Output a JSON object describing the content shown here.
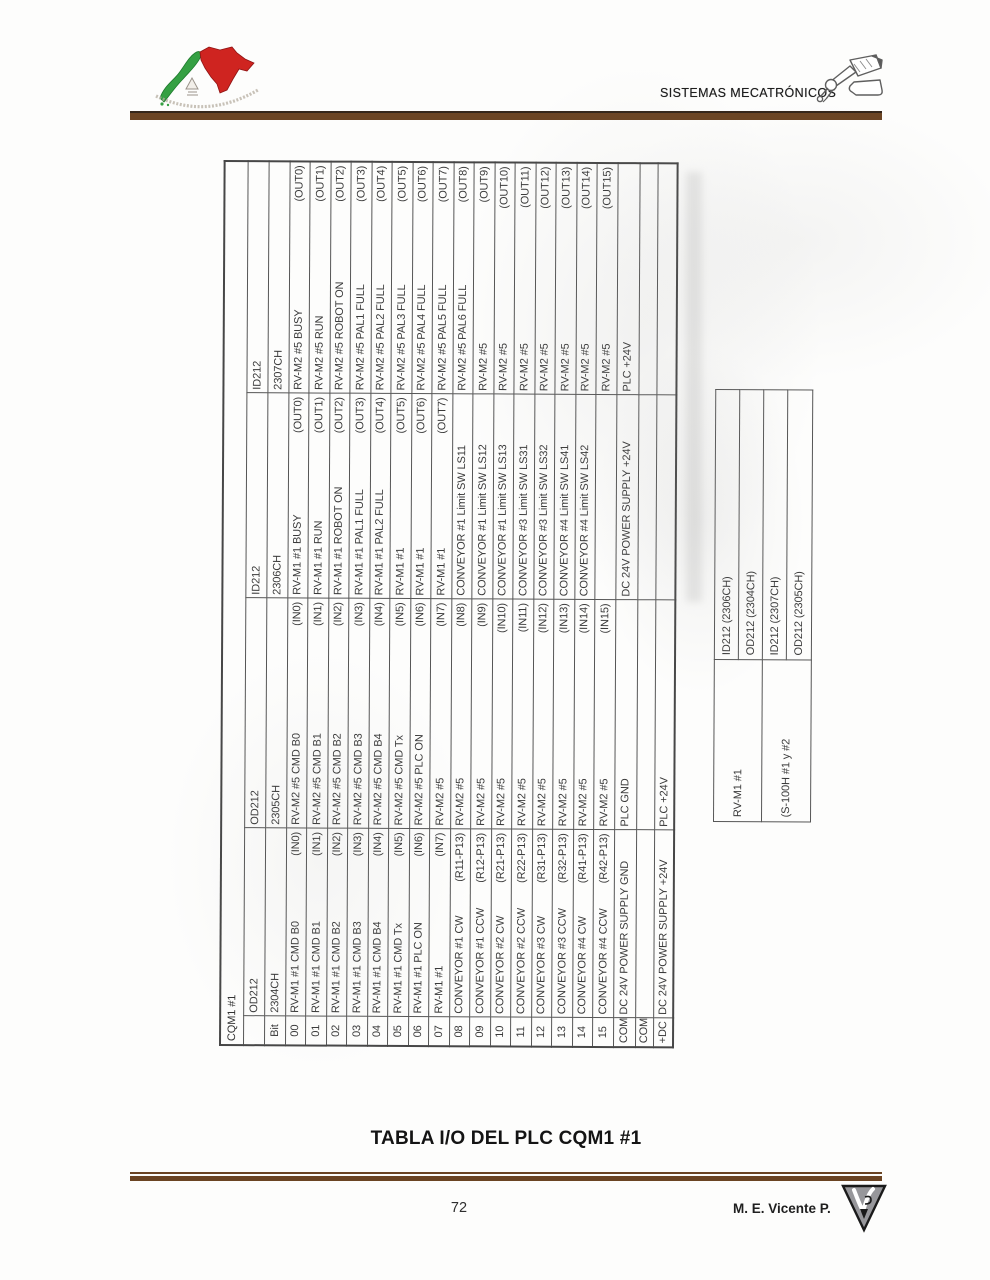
{
  "header": {
    "title": "SISTEMAS MECATRÓNICOS"
  },
  "main_table": {
    "title": "CQM1 #1",
    "bit_label": "Bit",
    "columns": [
      {
        "card": "OD212",
        "channel": "2304CH"
      },
      {
        "card": "OD212",
        "channel": "2305CH"
      },
      {
        "card": "ID212",
        "channel": "2306CH"
      },
      {
        "card": "ID212",
        "channel": "2307CH"
      }
    ],
    "rows": [
      {
        "bit": "00",
        "cells": [
          {
            "label": "RV-M1 #1 CMD B0",
            "pin": "(IN0)"
          },
          {
            "label": "RV-M2 #5 CMD B0",
            "pin": "(IN0)"
          },
          {
            "label": "RV-M1 #1 BUSY",
            "pin": "(OUT0)"
          },
          {
            "label": "RV-M2 #5 BUSY",
            "pin": "(OUT0)"
          }
        ]
      },
      {
        "bit": "01",
        "cells": [
          {
            "label": "RV-M1 #1 CMD B1",
            "pin": "(IN1)"
          },
          {
            "label": "RV-M2 #5 CMD B1",
            "pin": "(IN1)"
          },
          {
            "label": "RV-M1 #1 RUN",
            "pin": "(OUT1)"
          },
          {
            "label": "RV-M2 #5 RUN",
            "pin": "(OUT1)"
          }
        ]
      },
      {
        "bit": "02",
        "cells": [
          {
            "label": "RV-M1 #1 CMD B2",
            "pin": "(IN2)"
          },
          {
            "label": "RV-M2 #5 CMD B2",
            "pin": "(IN2)"
          },
          {
            "label": "RV-M1 #1 ROBOT ON",
            "pin": "(OUT2)"
          },
          {
            "label": "RV-M2 #5 ROBOT ON",
            "pin": "(OUT2)"
          }
        ]
      },
      {
        "bit": "03",
        "cells": [
          {
            "label": "RV-M1 #1 CMD B3",
            "pin": "(IN3)"
          },
          {
            "label": "RV-M2 #5 CMD B3",
            "pin": "(IN3)"
          },
          {
            "label": "RV-M1 #1 PAL1 FULL",
            "pin": "(OUT3)"
          },
          {
            "label": "RV-M2 #5 PAL1 FULL",
            "pin": "(OUT3)"
          }
        ]
      },
      {
        "bit": "04",
        "cells": [
          {
            "label": "RV-M1 #1 CMD B4",
            "pin": "(IN4)"
          },
          {
            "label": "RV-M2 #5 CMD B4",
            "pin": "(IN4)"
          },
          {
            "label": "RV-M1 #1 PAL2 FULL",
            "pin": "(OUT4)"
          },
          {
            "label": "RV-M2 #5 PAL2 FULL",
            "pin": "(OUT4)"
          }
        ]
      },
      {
        "bit": "05",
        "cells": [
          {
            "label": "RV-M1 #1 CMD Tx",
            "pin": "(IN5)"
          },
          {
            "label": "RV-M2 #5 CMD Tx",
            "pin": "(IN5)"
          },
          {
            "label": "RV-M1 #1",
            "pin": "(OUT5)"
          },
          {
            "label": "RV-M2 #5 PAL3 FULL",
            "pin": "(OUT5)"
          }
        ]
      },
      {
        "bit": "06",
        "cells": [
          {
            "label": "RV-M1 #1 PLC ON",
            "pin": "(IN6)"
          },
          {
            "label": "RV-M2 #5 PLC ON",
            "pin": "(IN6)"
          },
          {
            "label": "RV-M1 #1",
            "pin": "(OUT6)"
          },
          {
            "label": "RV-M2 #5 PAL4 FULL",
            "pin": "(OUT6)"
          }
        ]
      },
      {
        "bit": "07",
        "cells": [
          {
            "label": "RV-M1 #1",
            "pin": "(IN7)"
          },
          {
            "label": "RV-M2 #5",
            "pin": "(IN7)"
          },
          {
            "label": "RV-M1 #1",
            "pin": "(OUT7)"
          },
          {
            "label": "RV-M2 #5 PAL5 FULL",
            "pin": "(OUT7)"
          }
        ]
      },
      {
        "bit": "08",
        "cells": [
          {
            "label": "CONVEYOR #1 CW",
            "pin": "(R11-P13)"
          },
          {
            "label": "RV-M2 #5",
            "pin": "(IN8)"
          },
          {
            "label": "CONVEYOR #1 Limit SW LS11",
            "pin": ""
          },
          {
            "label": "RV-M2 #5 PAL6 FULL",
            "pin": "(OUT8)"
          }
        ]
      },
      {
        "bit": "09",
        "cells": [
          {
            "label": "CONVEYOR #1 CCW",
            "pin": "(R12-P13)"
          },
          {
            "label": "RV-M2 #5",
            "pin": "(IN9)"
          },
          {
            "label": "CONVEYOR #1 Limit SW LS12",
            "pin": ""
          },
          {
            "label": "RV-M2 #5",
            "pin": "(OUT9)"
          }
        ]
      },
      {
        "bit": "10",
        "cells": [
          {
            "label": "CONVEYOR #2 CW",
            "pin": "(R21-P13)"
          },
          {
            "label": "RV-M2 #5",
            "pin": "(IN10)"
          },
          {
            "label": "CONVEYOR #1 Limit SW LS13",
            "pin": ""
          },
          {
            "label": "RV-M2 #5",
            "pin": "(OUT10)"
          }
        ]
      },
      {
        "bit": "11",
        "cells": [
          {
            "label": "CONVEYOR #2 CCW",
            "pin": "(R22-P13)"
          },
          {
            "label": "RV-M2 #5",
            "pin": "(IN11)"
          },
          {
            "label": "CONVEYOR #3 Limit SW LS31",
            "pin": ""
          },
          {
            "label": "RV-M2 #5",
            "pin": "(OUT11)"
          }
        ]
      },
      {
        "bit": "12",
        "cells": [
          {
            "label": "CONVEYOR #3 CW",
            "pin": "(R31-P13)"
          },
          {
            "label": "RV-M2 #5",
            "pin": "(IN12)"
          },
          {
            "label": "CONVEYOR #3 Limit SW LS32",
            "pin": ""
          },
          {
            "label": "RV-M2 #5",
            "pin": "(OUT12)"
          }
        ]
      },
      {
        "bit": "13",
        "cells": [
          {
            "label": "CONVEYOR #3 CCW",
            "pin": "(R32-P13)"
          },
          {
            "label": "RV-M2 #5",
            "pin": "(IN13)"
          },
          {
            "label": "CONVEYOR #4 Limit SW LS41",
            "pin": ""
          },
          {
            "label": "RV-M2 #5",
            "pin": "(OUT13)"
          }
        ]
      },
      {
        "bit": "14",
        "cells": [
          {
            "label": "CONVEYOR #4 CW",
            "pin": "(R41-P13)"
          },
          {
            "label": "RV-M2 #5",
            "pin": "(IN14)"
          },
          {
            "label": "CONVEYOR #4 Limit SW LS42",
            "pin": ""
          },
          {
            "label": "RV-M2 #5",
            "pin": "(OUT14)"
          }
        ]
      },
      {
        "bit": "15",
        "cells": [
          {
            "label": "CONVEYOR #4 CCW",
            "pin": "(R42-P13)"
          },
          {
            "label": "RV-M2 #5",
            "pin": "(IN15)"
          },
          {
            "label": "",
            "pin": ""
          },
          {
            "label": "RV-M2 #5",
            "pin": "(OUT15)"
          }
        ]
      },
      {
        "bit": "COM",
        "cells": [
          {
            "label": "DC 24V POWER SUPPLY GND",
            "pin": ""
          },
          {
            "label": "PLC GND",
            "pin": ""
          },
          {
            "label": "DC 24V POWER SUPPLY +24V",
            "pin": ""
          },
          {
            "label": "PLC +24V",
            "pin": ""
          }
        ]
      },
      {
        "bit": "COM",
        "cells": [
          {
            "label": "",
            "pin": ""
          },
          {
            "label": "",
            "pin": ""
          },
          {
            "label": "",
            "pin": ""
          },
          {
            "label": "",
            "pin": ""
          }
        ]
      },
      {
        "bit": "+DC",
        "cells": [
          {
            "label": "DC 24V POWER SUPPLY +24V",
            "pin": ""
          },
          {
            "label": "PLC +24V",
            "pin": ""
          },
          {
            "label": "",
            "pin": ""
          },
          {
            "label": "",
            "pin": ""
          }
        ]
      }
    ]
  },
  "side_table": {
    "rows": [
      {
        "device": "RV-M1 #1",
        "channels": [
          "ID212 (2306CH)",
          "OD212 (2304CH)"
        ]
      },
      {
        "device": "(S-100H #1 y #2",
        "channels": [
          "ID212 (2307CH)",
          "OD212 (2305CH)"
        ]
      }
    ]
  },
  "caption": "TABLA I/O DEL PLC CQM1 #1",
  "footer": {
    "page_number": "72",
    "author": "M. E. Vicente P."
  },
  "colors": {
    "rule_brown": "#6b4423",
    "table_line": "#565656",
    "ink": "#3a3a3a",
    "japan_green": "#35a043",
    "mexico_red": "#cf2420",
    "logo_gray": "#97979b"
  }
}
